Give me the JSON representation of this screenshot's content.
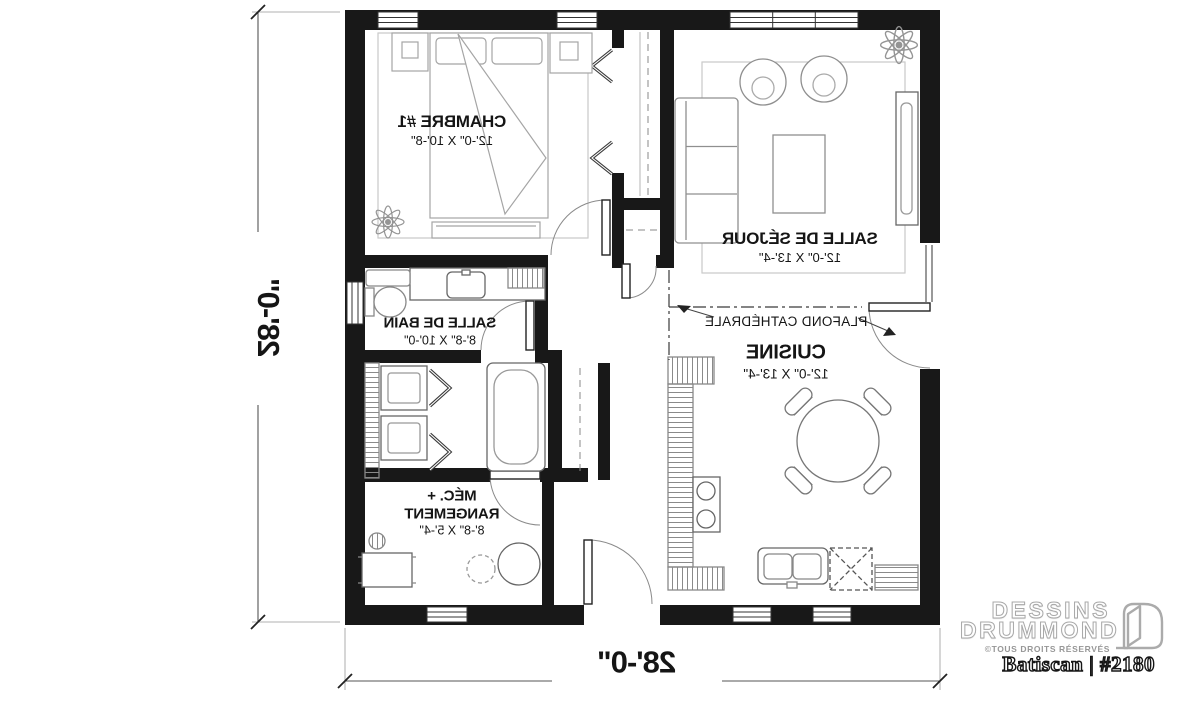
{
  "plan": {
    "rooms": {
      "bedroom": {
        "name": "CHAMBRE #1",
        "dims": "12'-0\" X 10'-8\""
      },
      "living": {
        "name": "SALLE DE SÉJOUR",
        "dims": "12'-0\" X 13'-4\""
      },
      "bathroom": {
        "name": "SALLE DE BAIN",
        "dims": "8'-8\" X 10'-0\""
      },
      "kitchen": {
        "name": "CUISINE",
        "dims": "12'-0\" X 13'-4\""
      },
      "mechanical": {
        "name_line1": "MÉC. +",
        "name_line2": "RANGEMENT",
        "dims": "8'-8\" X 5'-4\""
      }
    },
    "annotations": {
      "cathedral_ceiling": "PLAFOND CATHÉDRALE"
    },
    "dimensions": {
      "width": "28'-0\"",
      "height": "28'-0\""
    }
  },
  "branding": {
    "company_line1": "DESSINS",
    "company_line2": "DRUMMOND",
    "rights": "©TOUS DROITS RÉSERVÉS",
    "model": "Batiscan | #2180"
  }
}
